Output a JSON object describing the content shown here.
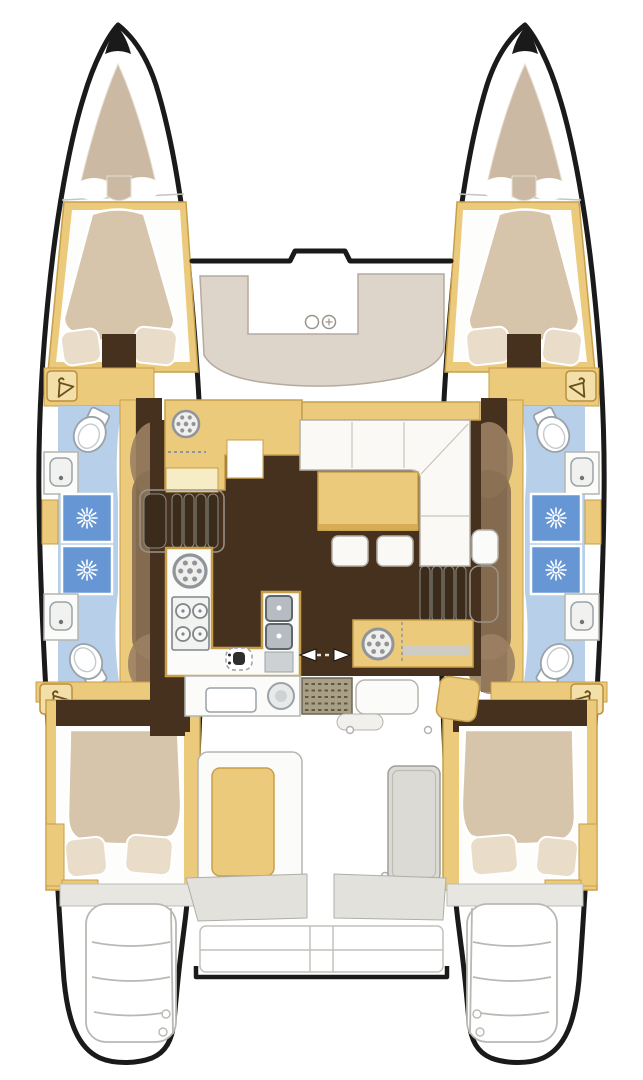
{
  "meta": {
    "title": "Catamaran interior deck plan (top-down floor plan)",
    "view": "top-down",
    "drawing_style": "brochure layout illustration, no text labels"
  },
  "colors": {
    "bg": "#ffffff",
    "outline": "#1a1a1a",
    "wood": "#ecca7c",
    "wood_edge": "#c79f4a",
    "wood_light": "#f6ecc6",
    "deck_pad": "#cbb9a3",
    "cushion": "#d6c4ab",
    "cushion_light": "#e9ddca",
    "deck_seat": "#ddd4ca",
    "floor_dark": "#46301e",
    "blob": "#8a7154",
    "blob_light": "#9b8163",
    "bath_floor": "#b7cfe9",
    "shower": "#6697d4",
    "white_surface": "#fbfbf9",
    "gray_line": "#b5b5af",
    "soft_line": "#c6c6c0",
    "steel": "#b6bcc1",
    "steel_dark": "#5f666c",
    "fixture_line": "#9aa2a8",
    "deck_gray": "#e3e1db",
    "mat": "#a89f86",
    "mat_dot": "#5f5944",
    "step_slat": "#3a2b1b",
    "icon_line": "#8f959b"
  },
  "vessel": {
    "type": "catamaran",
    "hulls": 2,
    "port_hull": {
      "forepeak": "bow sun pad",
      "forward_cabin": {
        "berth": "double tapered",
        "pillows": 2,
        "wardrobe_hanging_locker": 1
      },
      "head_compartment": {
        "toilets": 2,
        "washbasins": 2,
        "shower_stalls": 2
      },
      "aft_cabin": {
        "berth": "double",
        "pillows": 2,
        "wardrobe_hanging_locker": 1
      },
      "transom": "swim steps"
    },
    "starboard_hull": {
      "forepeak": "bow sun pad",
      "forward_cabin": {
        "berth": "double tapered",
        "pillows": 2,
        "wardrobe_hanging_locker": 1
      },
      "head_compartment": {
        "toilets": 2,
        "washbasins": 2,
        "shower_stalls": 2
      },
      "aft_cabin": {
        "berth": "double",
        "pillows": 2,
        "wardrobe_hanging_locker": 1
      },
      "transom": "swim steps"
    },
    "bridgedeck": {
      "foredeck_lounge": {
        "seat": "C-shaped pad",
        "cup_holders": 2
      },
      "salon": {
        "galley": {
          "stove_burners": 4,
          "round_sink": 1,
          "double_sink": 1,
          "worktop_fixture_dial": 1,
          "aft_counter_appliances": 2
        },
        "sofa": "L-shaped",
        "coffee_table": 1,
        "ottomans": 2,
        "nav_station": {
          "desk": 1,
          "instrument_dial": 1,
          "seat": 1
        },
        "companionway_steps": 2,
        "sliding_door_marker": "double arrow"
      },
      "cockpit": {
        "bench_with_cushion": 1,
        "aft_benches": 2,
        "table": 1,
        "entry_mat": 1
      },
      "transom_platform": "between hulls with davit bar"
    }
  }
}
